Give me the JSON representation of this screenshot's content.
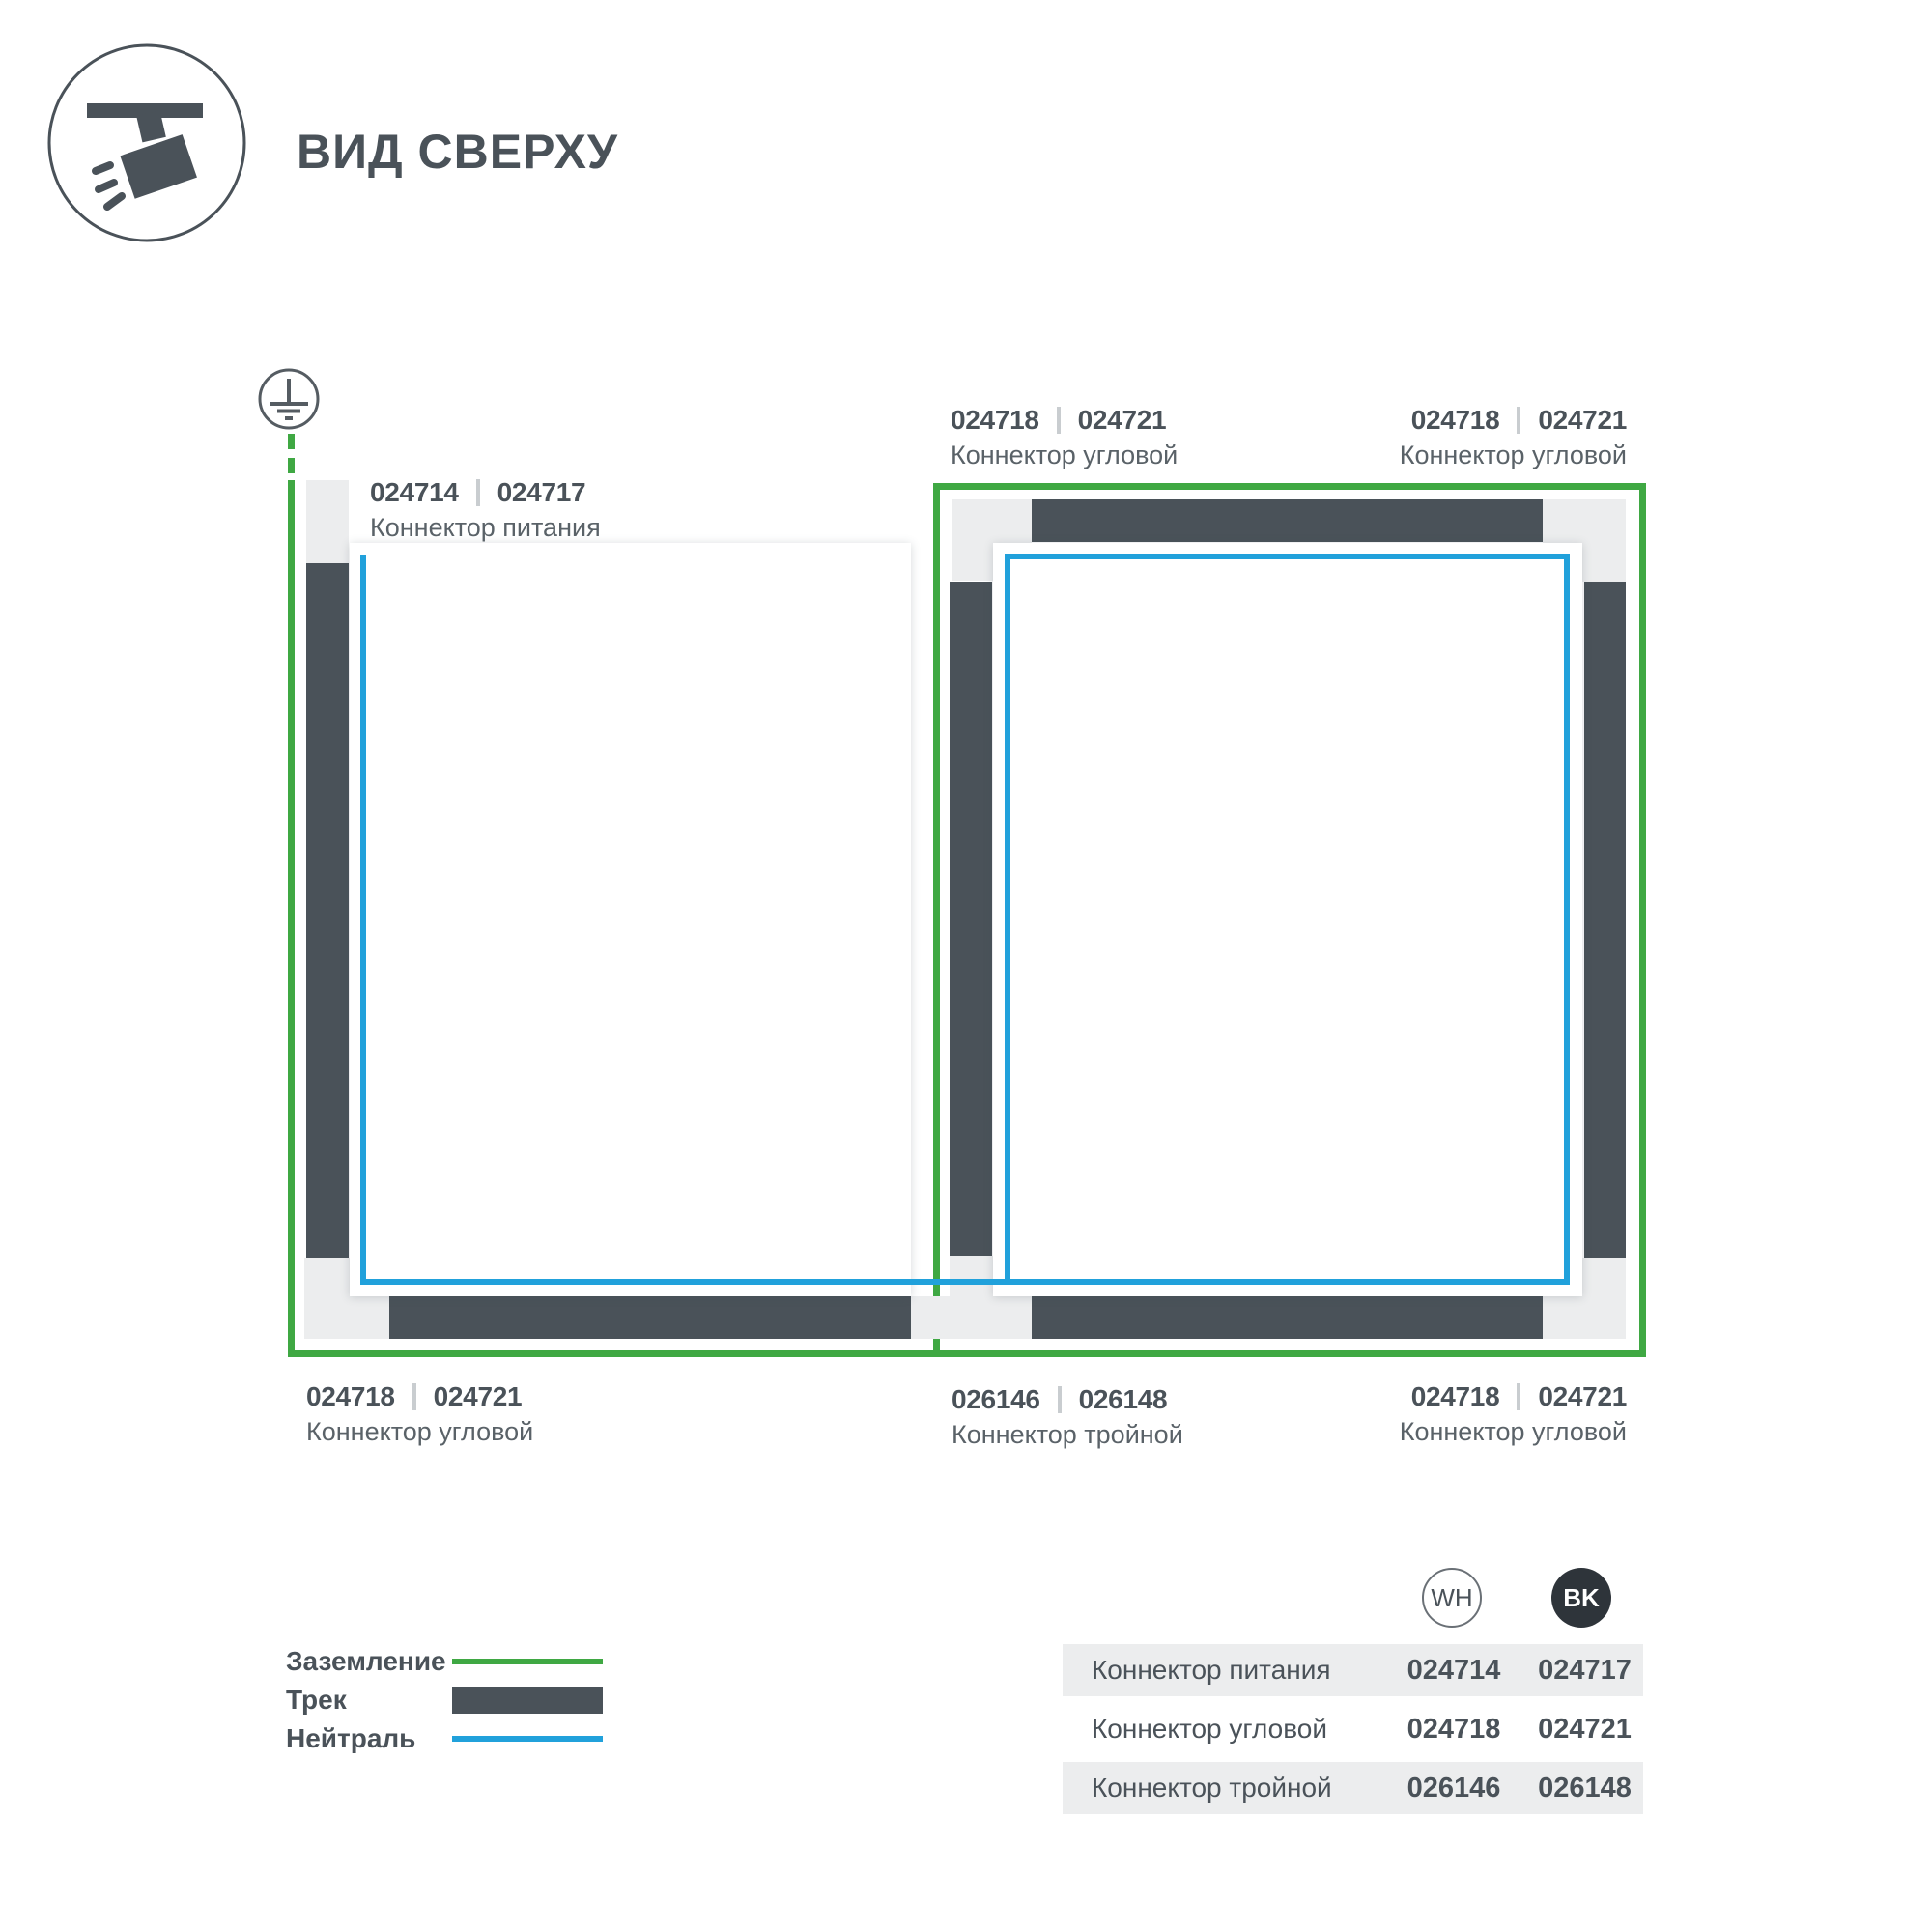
{
  "header": {
    "title": "ВИД СВЕРХУ"
  },
  "icons": {
    "spotlight": "track-spotlight-top-view",
    "ground": "earth-ground-symbol"
  },
  "colors": {
    "ground_green": "#3FA843",
    "track_dark": "#4A5259",
    "neutral_blue": "#21A1DB",
    "connector_gray": "#ECEDEE"
  },
  "callouts": {
    "power": {
      "wh": "024714",
      "bk": "024717",
      "name": "Коннектор питания"
    },
    "corner_top_left": {
      "wh": "024718",
      "bk": "024721",
      "name": "Коннектор угловой"
    },
    "corner_top_right": {
      "wh": "024718",
      "bk": "024721",
      "name": "Коннектор угловой"
    },
    "corner_bottom_left": {
      "wh": "024718",
      "bk": "024721",
      "name": "Коннектор угловой"
    },
    "triple": {
      "wh": "026146",
      "bk": "026148",
      "name": "Коннектор тройной"
    },
    "corner_bottom_right": {
      "wh": "024718",
      "bk": "024721",
      "name": "Коннектор угловой"
    }
  },
  "legend": {
    "items": [
      {
        "label": "Заземление",
        "type": "ground"
      },
      {
        "label": "Трек",
        "type": "track"
      },
      {
        "label": "Нейтраль",
        "type": "neutral"
      }
    ]
  },
  "table": {
    "columns": {
      "wh": "WH",
      "bk": "BK"
    },
    "rows": [
      {
        "name": "Коннектор питания",
        "wh": "024714",
        "bk": "024717"
      },
      {
        "name": "Коннектор угловой",
        "wh": "024718",
        "bk": "024721"
      },
      {
        "name": "Коннектор тройной",
        "wh": "026146",
        "bk": "026148"
      }
    ]
  }
}
